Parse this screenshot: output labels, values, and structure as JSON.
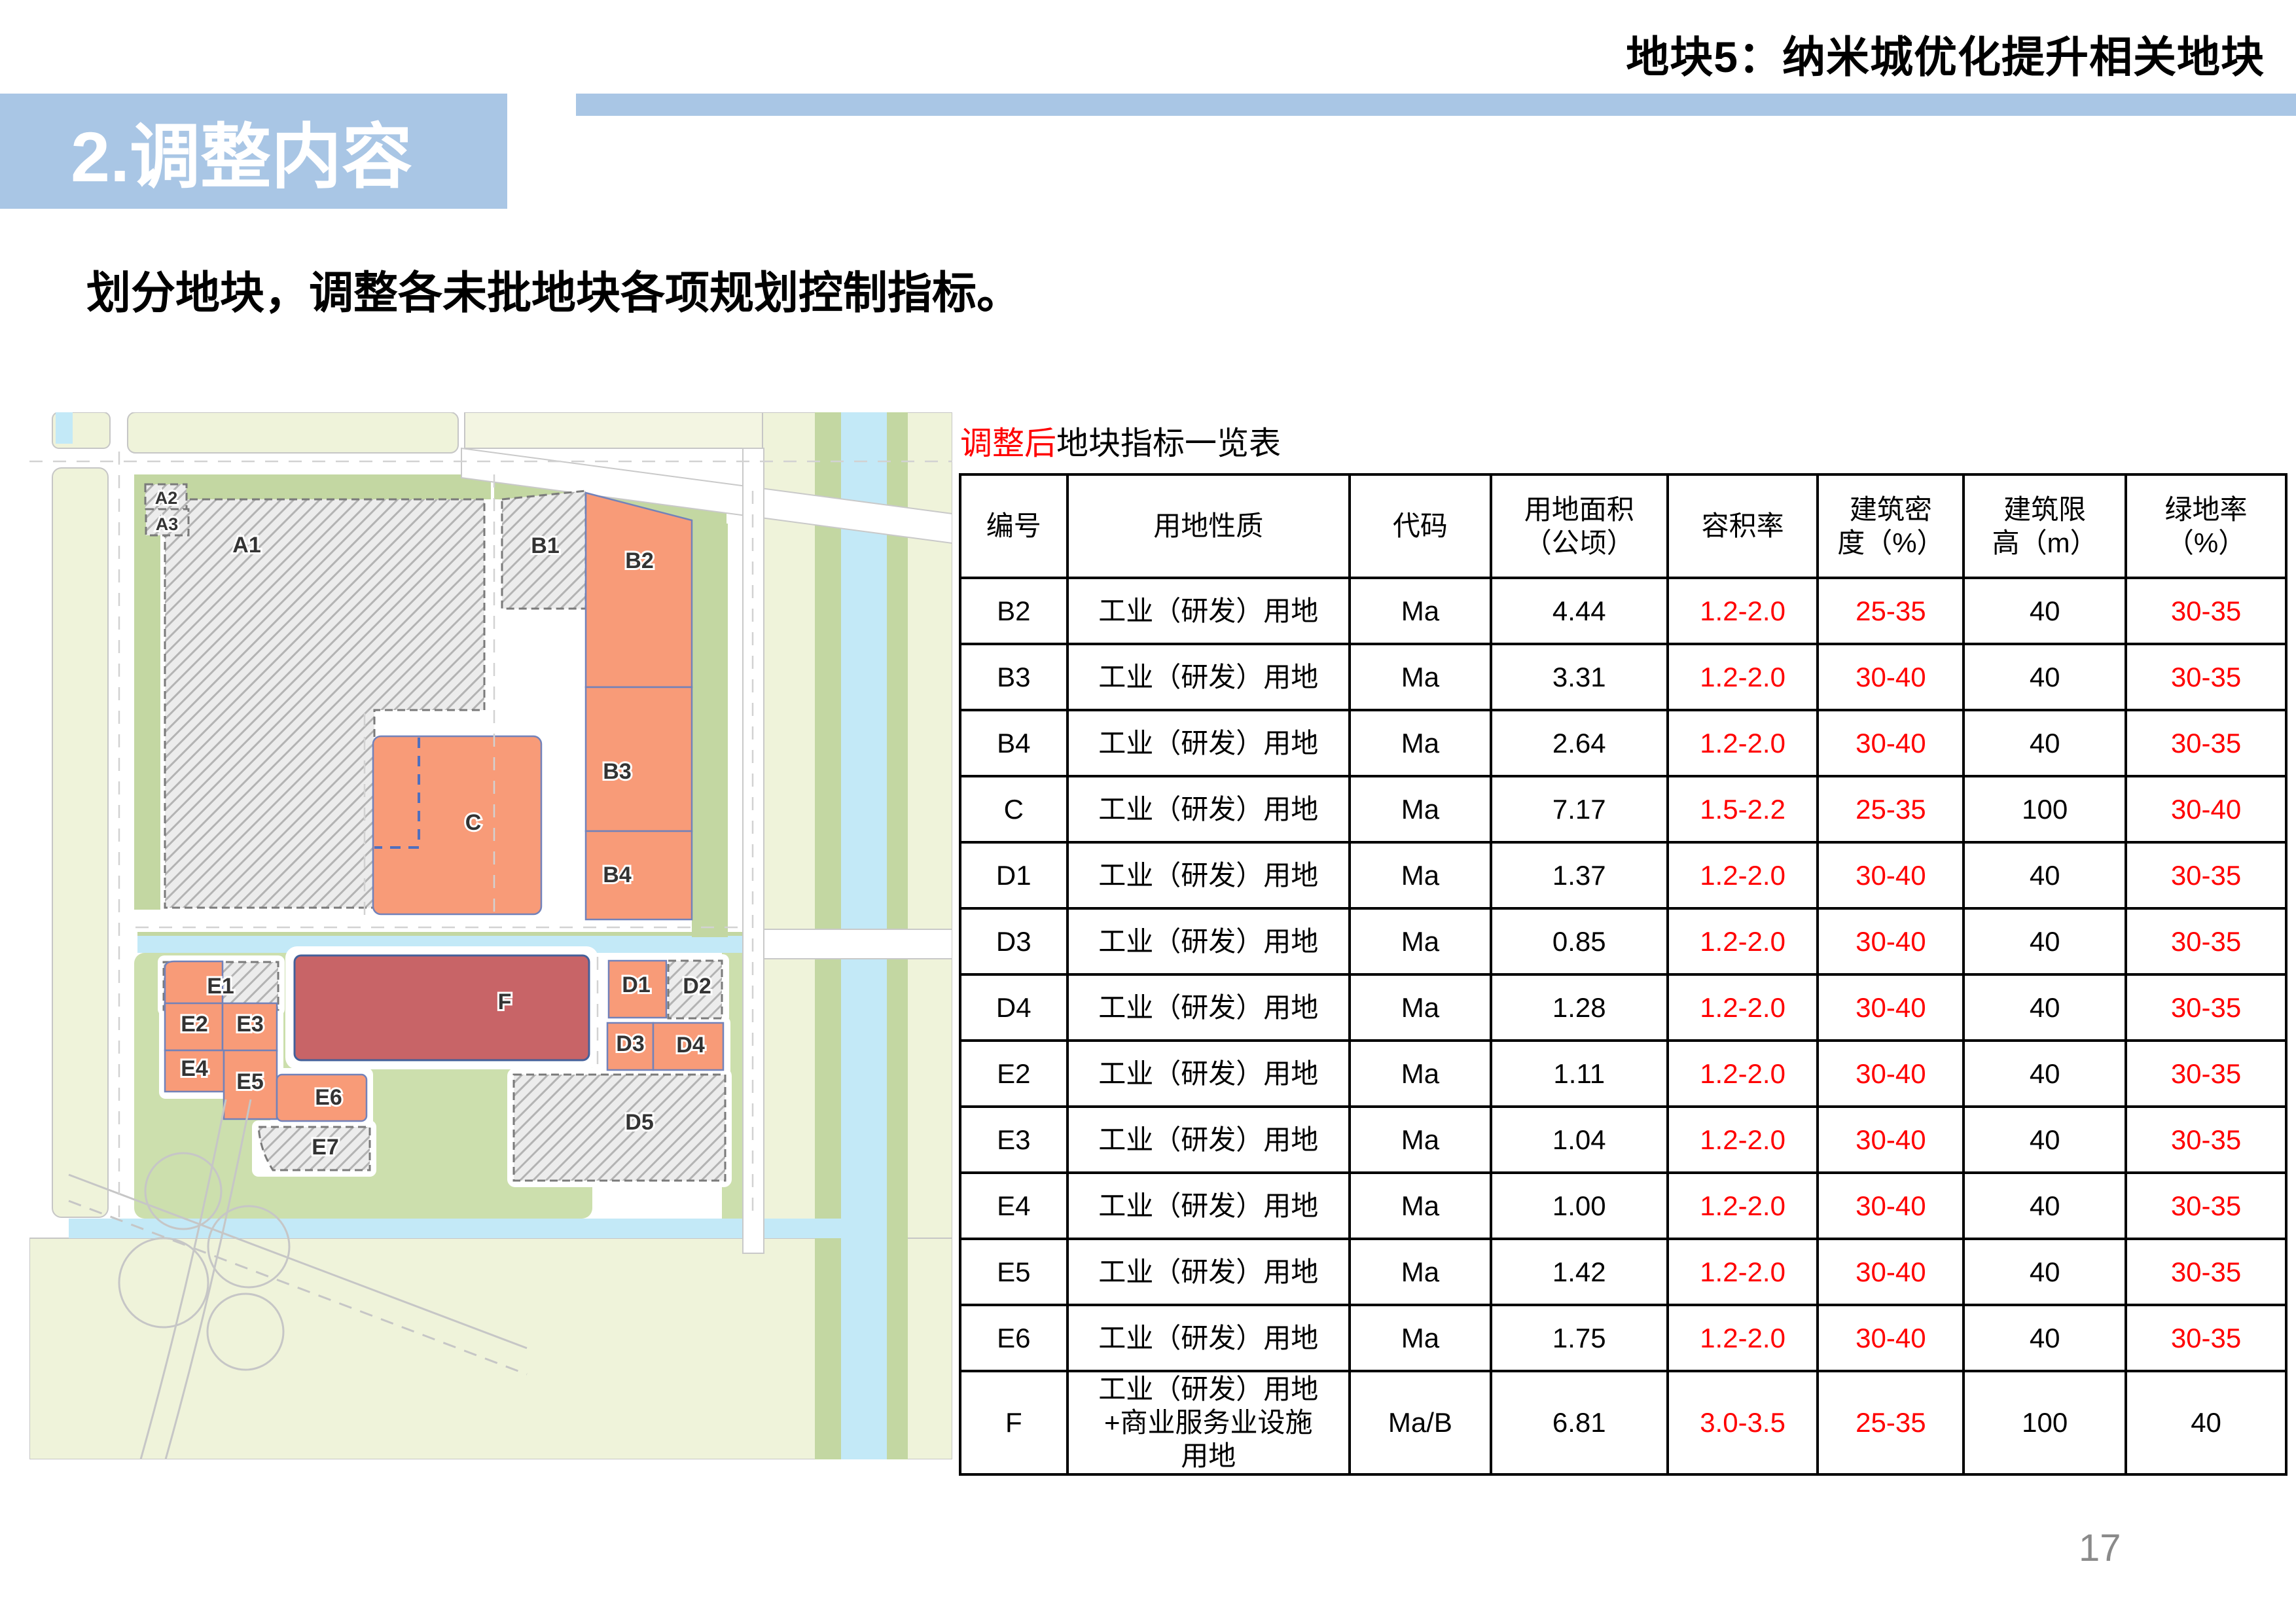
{
  "slide": {
    "header_title": "地块5：纳米城优化提升相关地块",
    "section_label": "2.调整内容",
    "subtitle": "划分地块，调整各未批地块各项规划控制指标。",
    "page_number": "17",
    "accent_blue": "#a9c6e5"
  },
  "map": {
    "labels": {
      "a1": "A1",
      "a2": "A2",
      "a3": "A3",
      "b1": "B1",
      "b2": "B2",
      "b3": "B3",
      "b4": "B4",
      "c": "C",
      "d1": "D1",
      "d2": "D2",
      "d3": "D3",
      "d4": "D4",
      "d5": "D5",
      "e1": "E1",
      "e2": "E2",
      "e3": "E3",
      "e4": "E4",
      "e5": "E5",
      "e6": "E6",
      "e7": "E7",
      "f": "F"
    },
    "colors": {
      "orange_parcel": "#f89b78",
      "red_parcel": "#c86467",
      "hatch_fill": "#ececec",
      "green_strip": "#c3d7a2",
      "green_area": "#ccdfad",
      "pale_block": "#eff3da",
      "water": "#c3e9f7",
      "road": "#ffffff"
    }
  },
  "table": {
    "title_highlight": "调整后",
    "title_rest": "地块指标一览表",
    "headers": [
      "编号",
      "用地性质",
      "代码",
      "用地面积\n（公顷）",
      "容积率",
      "建筑密\n度（%）",
      "建筑限\n高（m）",
      "绿地率\n（%）"
    ],
    "red_color": "#ff0000",
    "rows": [
      {
        "id": "B2",
        "nature": "工业（研发）用地",
        "code": "Ma",
        "area": "4.44",
        "far": "1.2-2.0",
        "density": "25-35",
        "height": "40",
        "green": "30-35",
        "green_red": true,
        "tall": false
      },
      {
        "id": "B3",
        "nature": "工业（研发）用地",
        "code": "Ma",
        "area": "3.31",
        "far": "1.2-2.0",
        "density": "30-40",
        "height": "40",
        "green": "30-35",
        "green_red": true,
        "tall": false
      },
      {
        "id": "B4",
        "nature": "工业（研发）用地",
        "code": "Ma",
        "area": "2.64",
        "far": "1.2-2.0",
        "density": "30-40",
        "height": "40",
        "green": "30-35",
        "green_red": true,
        "tall": false
      },
      {
        "id": "C",
        "nature": "工业（研发）用地",
        "code": "Ma",
        "area": "7.17",
        "far": "1.5-2.2",
        "density": "25-35",
        "height": "100",
        "green": "30-40",
        "green_red": true,
        "tall": false
      },
      {
        "id": "D1",
        "nature": "工业（研发）用地",
        "code": "Ma",
        "area": "1.37",
        "far": "1.2-2.0",
        "density": "30-40",
        "height": "40",
        "green": "30-35",
        "green_red": true,
        "tall": false
      },
      {
        "id": "D3",
        "nature": "工业（研发）用地",
        "code": "Ma",
        "area": "0.85",
        "far": "1.2-2.0",
        "density": "30-40",
        "height": "40",
        "green": "30-35",
        "green_red": true,
        "tall": false
      },
      {
        "id": "D4",
        "nature": "工业（研发）用地",
        "code": "Ma",
        "area": "1.28",
        "far": "1.2-2.0",
        "density": "30-40",
        "height": "40",
        "green": "30-35",
        "green_red": true,
        "tall": false
      },
      {
        "id": "E2",
        "nature": "工业（研发）用地",
        "code": "Ma",
        "area": "1.11",
        "far": "1.2-2.0",
        "density": "30-40",
        "height": "40",
        "green": "30-35",
        "green_red": true,
        "tall": false
      },
      {
        "id": "E3",
        "nature": "工业（研发）用地",
        "code": "Ma",
        "area": "1.04",
        "far": "1.2-2.0",
        "density": "30-40",
        "height": "40",
        "green": "30-35",
        "green_red": true,
        "tall": false
      },
      {
        "id": "E4",
        "nature": "工业（研发）用地",
        "code": "Ma",
        "area": "1.00",
        "far": "1.2-2.0",
        "density": "30-40",
        "height": "40",
        "green": "30-35",
        "green_red": true,
        "tall": false
      },
      {
        "id": "E5",
        "nature": "工业（研发）用地",
        "code": "Ma",
        "area": "1.42",
        "far": "1.2-2.0",
        "density": "30-40",
        "height": "40",
        "green": "30-35",
        "green_red": true,
        "tall": false
      },
      {
        "id": "E6",
        "nature": "工业（研发）用地",
        "code": "Ma",
        "area": "1.75",
        "far": "1.2-2.0",
        "density": "30-40",
        "height": "40",
        "green": "30-35",
        "green_red": true,
        "tall": false
      },
      {
        "id": "F",
        "nature": "工业（研发）用地\n+商业服务业设施\n用地",
        "code": "Ma/B",
        "area": "6.81",
        "far": "3.0-3.5",
        "density": "25-35",
        "height": "100",
        "green": "40",
        "green_red": false,
        "tall": true
      }
    ]
  }
}
